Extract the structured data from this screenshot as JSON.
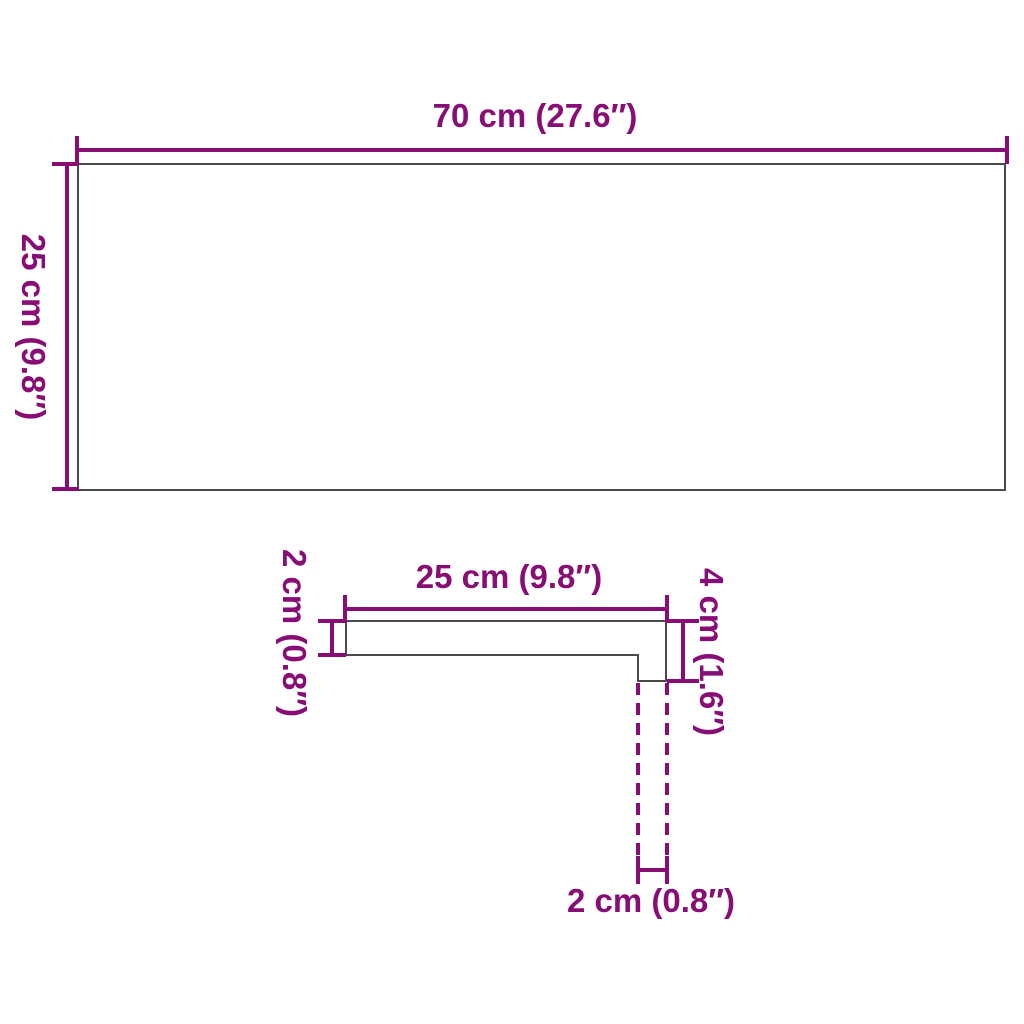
{
  "colors": {
    "accent": "#880E75",
    "outline": "#4A4A4A",
    "surface": "#FFFFFF"
  },
  "top_view": {
    "width_label": "70 cm (27.6″)",
    "height_label": "25 cm (9.8″)"
  },
  "profile_view": {
    "width_label": "25 cm (9.8″)",
    "thickness_label": "2 cm (0.8″)",
    "nose_height_label": "4 cm (1.6″)",
    "nose_width_label": "2 cm (0.8″)"
  }
}
